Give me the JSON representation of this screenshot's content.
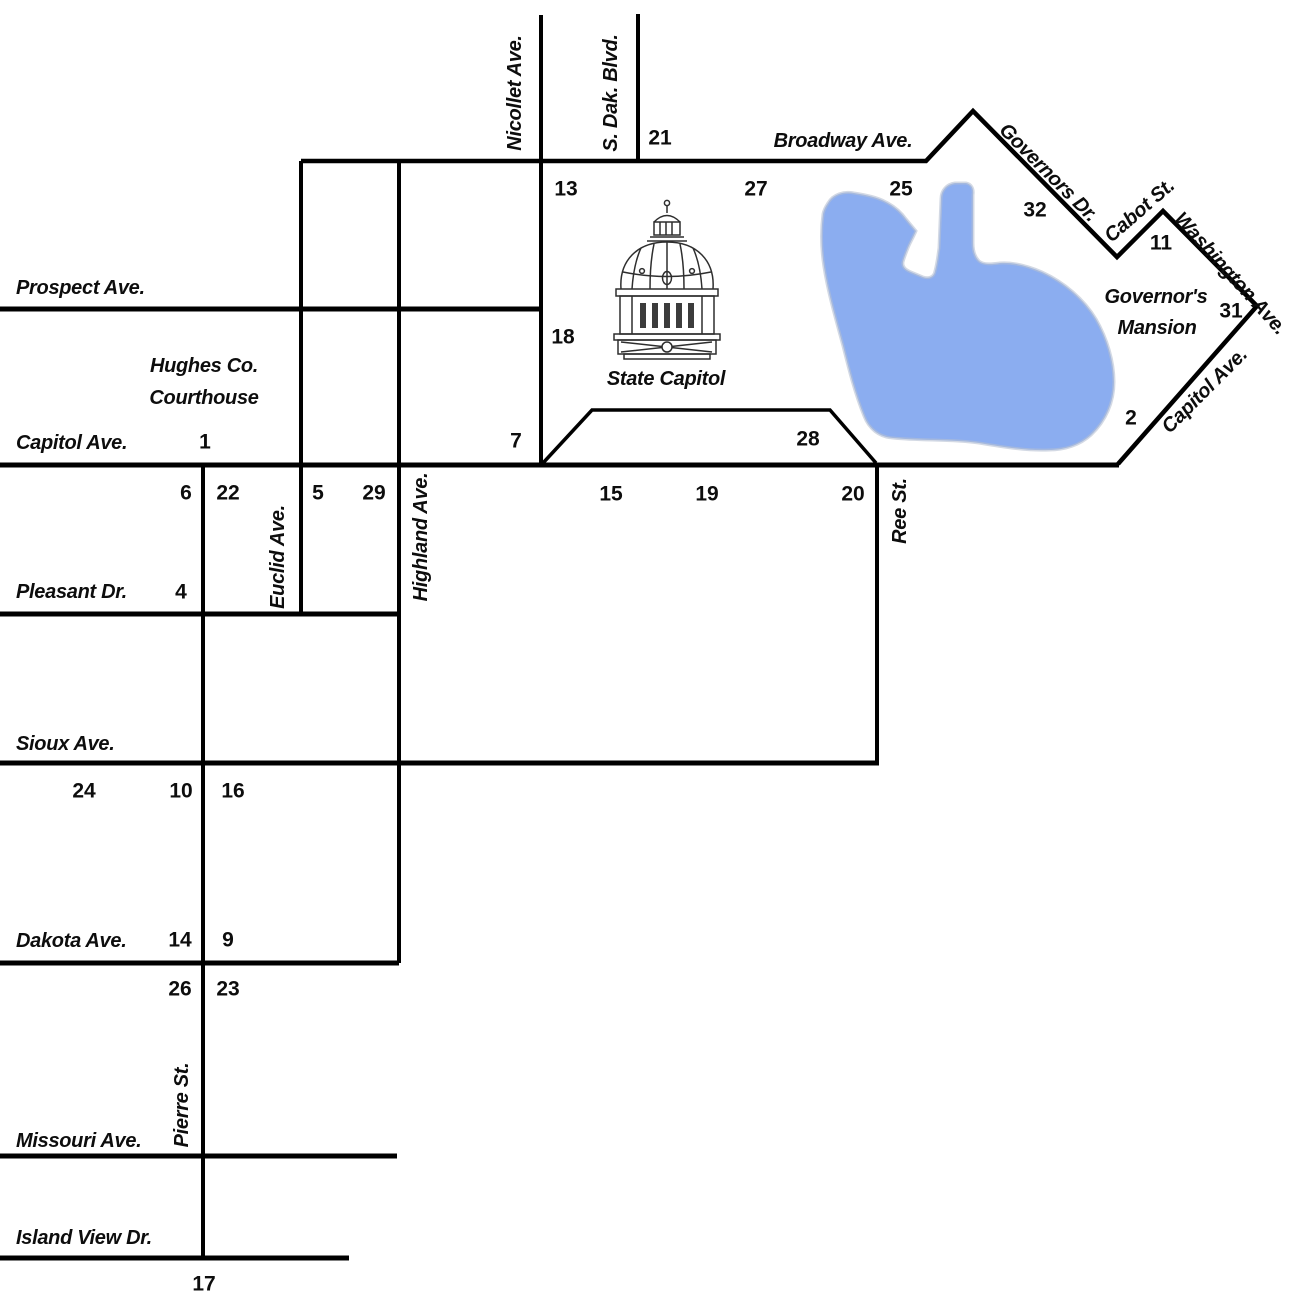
{
  "map": {
    "colors": {
      "background": "#ffffff",
      "line": "#000000",
      "text": "#0d0d0d",
      "lake": "#8badf0",
      "lake_edge": "#b6bfd2"
    },
    "lake": {
      "name": "capitol-lake",
      "path": "M 828 203 C 833 194 844 191 854 193 C 866 195 877 197 886 202 C 894 206 901 212 906 219 L 916 231 C 913 238 910 243 908 248 C 906 253 904 258 903 262 C 902 267 906 270 911 272 L 923 277 C 929 279 934 277 935 271 C 937 264 938 255 939 248 L 941 199 C 941 190 947 184 955 183 L 966 183 C 971 184 974 188 973 195 L 973 243 C 973 250 975 257 979 261 C 984 265 992 264 1000 263 C 1014 262 1028 266 1042 272 C 1064 282 1084 299 1096 319 C 1107 338 1114 361 1114 382 C 1114 402 1106 421 1091 435 C 1080 445 1065 450 1049 450 C 1027 451 1003 447 979 443 C 951 439 921 441 893 438 C 879 437 869 429 864 416 C 855 394 849 370 843 346 C 836 320 828 293 824 267 C 821 248 821 229 823 214 C 824 209 826 206 828 203 Z"
    },
    "streets": [
      {
        "name": "prospect-ave-line",
        "w": 5,
        "points": [
          [
            0,
            309
          ],
          [
            541,
            309
          ]
        ]
      },
      {
        "name": "capitol-ave-line",
        "w": 5,
        "points": [
          [
            0,
            465
          ],
          [
            1119,
            465
          ]
        ]
      },
      {
        "name": "pleasant-dr-line",
        "w": 5,
        "points": [
          [
            0,
            614
          ],
          [
            399,
            614
          ]
        ]
      },
      {
        "name": "sioux-ave-line",
        "w": 5,
        "points": [
          [
            0,
            763
          ],
          [
            879,
            763
          ]
        ]
      },
      {
        "name": "dakota-ave-line",
        "w": 5,
        "points": [
          [
            0,
            963
          ],
          [
            399,
            963
          ]
        ]
      },
      {
        "name": "missouri-ave-line",
        "w": 5,
        "points": [
          [
            0,
            1156
          ],
          [
            397,
            1156
          ]
        ]
      },
      {
        "name": "island-view-dr-line",
        "w": 5,
        "points": [
          [
            0,
            1258
          ],
          [
            349,
            1258
          ]
        ]
      },
      {
        "name": "broadway-governors-cabot-washington-capitol-loop",
        "w": 4.5,
        "points": [
          [
            301,
            161
          ],
          [
            926,
            161
          ],
          [
            973,
            111
          ],
          [
            1117,
            257
          ],
          [
            1163,
            211
          ],
          [
            1257,
            306
          ],
          [
            1118,
            464
          ]
        ]
      },
      {
        "name": "nicollet-ave-line",
        "w": 4,
        "points": [
          [
            541,
            15
          ],
          [
            541,
            465
          ]
        ]
      },
      {
        "name": "s-dak-blvd-line",
        "w": 4,
        "points": [
          [
            638,
            14
          ],
          [
            638,
            161
          ]
        ]
      },
      {
        "name": "euclid-ave-line",
        "w": 4,
        "points": [
          [
            301,
            161
          ],
          [
            301,
            614
          ]
        ]
      },
      {
        "name": "highland-ave-line",
        "w": 4,
        "points": [
          [
            399,
            161
          ],
          [
            399,
            963
          ]
        ]
      },
      {
        "name": "pierre-st-line",
        "w": 4,
        "points": [
          [
            203,
            465
          ],
          [
            203,
            1258
          ]
        ]
      },
      {
        "name": "ree-st-line",
        "w": 4,
        "points": [
          [
            877,
            465
          ],
          [
            877,
            763
          ]
        ]
      },
      {
        "name": "capitol-grounds-trapezoid",
        "w": 3.5,
        "points": [
          [
            543,
            463
          ],
          [
            592,
            410
          ],
          [
            830,
            410
          ],
          [
            876,
            463
          ]
        ]
      }
    ],
    "labels": [
      {
        "id": "nicollet-ave",
        "text": "Nicollet Ave.",
        "x": 514,
        "y": 93,
        "rot": -90,
        "anchor": "middle"
      },
      {
        "id": "s-dak-blvd",
        "text": "S. Dak. Blvd.",
        "x": 610,
        "y": 93,
        "rot": -90,
        "anchor": "middle"
      },
      {
        "id": "broadway-ave",
        "text": "Broadway Ave.",
        "x": 843,
        "y": 140,
        "rot": 0,
        "anchor": "middle"
      },
      {
        "id": "governors-dr",
        "text": "Governors Dr.",
        "x": 1049,
        "y": 172,
        "rot": 45,
        "anchor": "middle"
      },
      {
        "id": "cabot-st",
        "text": "Cabot St.",
        "x": 1139,
        "y": 210,
        "rot": -41,
        "anchor": "middle"
      },
      {
        "id": "washington-ave",
        "text": "Washington Ave.",
        "x": 1231,
        "y": 273,
        "rot": 48,
        "anchor": "middle"
      },
      {
        "id": "governors-mansion-line1",
        "text": "Governor's",
        "x": 1156,
        "y": 296,
        "rot": 0,
        "anchor": "middle"
      },
      {
        "id": "governors-mansion-line2",
        "text": "Mansion",
        "x": 1157,
        "y": 327,
        "rot": 0,
        "anchor": "middle"
      },
      {
        "id": "capitol-ave-diagonal",
        "text": "Capitol Ave.",
        "x": 1204,
        "y": 390,
        "rot": -45,
        "anchor": "middle"
      },
      {
        "id": "prospect-ave",
        "text": "Prospect Ave.",
        "x": 16,
        "y": 287,
        "rot": 0,
        "anchor": "start"
      },
      {
        "id": "hughes-courthouse-line1",
        "text": "Hughes Co.",
        "x": 204,
        "y": 365,
        "rot": 0,
        "anchor": "middle"
      },
      {
        "id": "hughes-courthouse-line2",
        "text": "Courthouse",
        "x": 204,
        "y": 397,
        "rot": 0,
        "anchor": "middle"
      },
      {
        "id": "capitol-ave-west",
        "text": "Capitol Ave.",
        "x": 16,
        "y": 442,
        "rot": 0,
        "anchor": "start"
      },
      {
        "id": "state-capitol",
        "text": "State Capitol",
        "x": 666,
        "y": 378,
        "rot": 0,
        "anchor": "middle"
      },
      {
        "id": "euclid-ave",
        "text": "Euclid Ave.",
        "x": 277,
        "y": 557,
        "rot": -90,
        "anchor": "middle"
      },
      {
        "id": "highland-ave",
        "text": "Highland Ave.",
        "x": 420,
        "y": 537,
        "rot": -90,
        "anchor": "middle"
      },
      {
        "id": "ree-st",
        "text": "Ree St.",
        "x": 899,
        "y": 511,
        "rot": -90,
        "anchor": "middle"
      },
      {
        "id": "pleasant-dr",
        "text": "Pleasant Dr.",
        "x": 16,
        "y": 591,
        "rot": 0,
        "anchor": "start"
      },
      {
        "id": "sioux-ave",
        "text": "Sioux Ave.",
        "x": 16,
        "y": 743,
        "rot": 0,
        "anchor": "start"
      },
      {
        "id": "dakota-ave",
        "text": "Dakota Ave.",
        "x": 16,
        "y": 940,
        "rot": 0,
        "anchor": "start"
      },
      {
        "id": "pierre-st",
        "text": "Pierre St.",
        "x": 181,
        "y": 1105,
        "rot": -90,
        "anchor": "middle"
      },
      {
        "id": "missouri-ave",
        "text": "Missouri Ave.",
        "x": 16,
        "y": 1140,
        "rot": 0,
        "anchor": "start"
      },
      {
        "id": "island-view-dr",
        "text": "Island View Dr.",
        "x": 16,
        "y": 1237,
        "rot": 0,
        "anchor": "start"
      }
    ],
    "numbers": [
      {
        "n": "21",
        "x": 660,
        "y": 137
      },
      {
        "n": "13",
        "x": 566,
        "y": 188
      },
      {
        "n": "27",
        "x": 756,
        "y": 188
      },
      {
        "n": "25",
        "x": 901,
        "y": 188
      },
      {
        "n": "32",
        "x": 1035,
        "y": 209
      },
      {
        "n": "11",
        "x": 1161,
        "y": 242
      },
      {
        "n": "31",
        "x": 1231,
        "y": 310
      },
      {
        "n": "2",
        "x": 1131,
        "y": 417
      },
      {
        "n": "18",
        "x": 563,
        "y": 336
      },
      {
        "n": "7",
        "x": 516,
        "y": 440
      },
      {
        "n": "28",
        "x": 808,
        "y": 438
      },
      {
        "n": "1",
        "x": 205,
        "y": 441
      },
      {
        "n": "6",
        "x": 186,
        "y": 492
      },
      {
        "n": "22",
        "x": 228,
        "y": 492
      },
      {
        "n": "5",
        "x": 318,
        "y": 492
      },
      {
        "n": "29",
        "x": 374,
        "y": 492
      },
      {
        "n": "15",
        "x": 611,
        "y": 493
      },
      {
        "n": "19",
        "x": 707,
        "y": 493
      },
      {
        "n": "20",
        "x": 853,
        "y": 493
      },
      {
        "n": "4",
        "x": 181,
        "y": 591
      },
      {
        "n": "24",
        "x": 84,
        "y": 790
      },
      {
        "n": "10",
        "x": 181,
        "y": 790
      },
      {
        "n": "16",
        "x": 233,
        "y": 790
      },
      {
        "n": "14",
        "x": 180,
        "y": 939
      },
      {
        "n": "9",
        "x": 228,
        "y": 939
      },
      {
        "n": "26",
        "x": 180,
        "y": 988
      },
      {
        "n": "23",
        "x": 228,
        "y": 988
      },
      {
        "n": "17",
        "x": 204,
        "y": 1283
      }
    ]
  }
}
